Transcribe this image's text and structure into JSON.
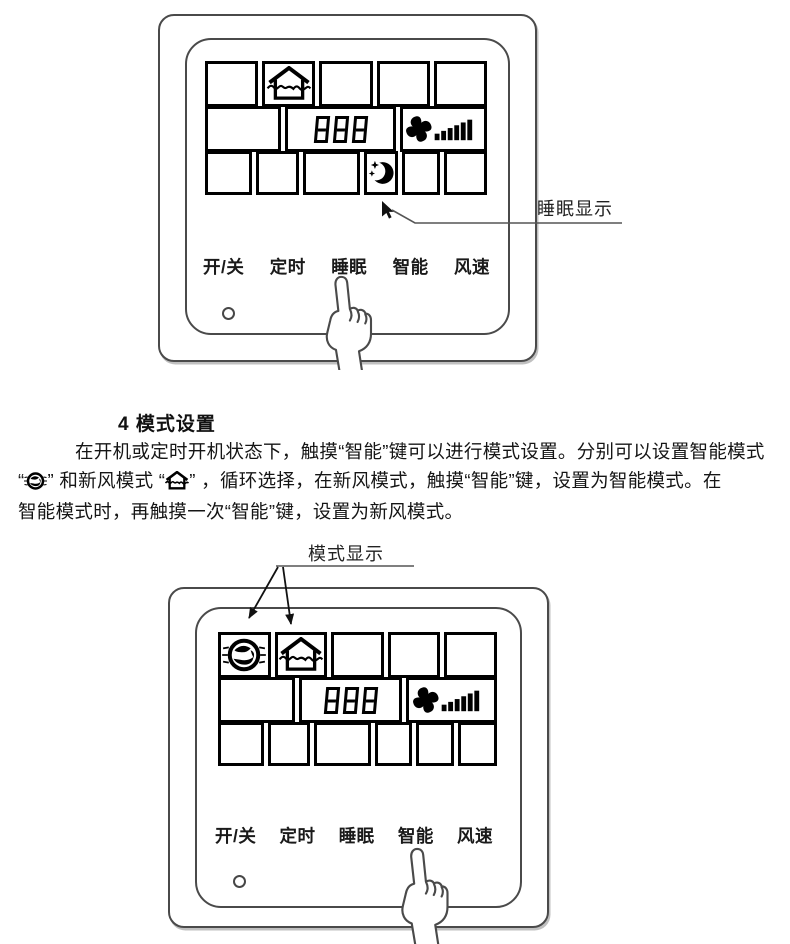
{
  "colors": {
    "ink": "#111111",
    "panel_outline": "#4a4a4a",
    "lcd_line": "#000000",
    "background": "#ffffff"
  },
  "panel_top": {
    "display": {
      "digits": "888",
      "fresh_air_icon": "house-airflow-icon",
      "fan_speed_icon": "fan-speed-bars-icon",
      "sleep_icon": "moon-stars-icon"
    },
    "annotation": "睡眠显示",
    "buttons": [
      "开/关",
      "定时",
      "睡眠",
      "智能",
      "风速"
    ],
    "touched_button": "睡眠"
  },
  "instructions": {
    "heading": "4 模式设置",
    "line1": "在开机或定时开机状态下，触摸“智能”键可以进行模式设置。分别可以设置智能模式",
    "line2_open_quote": "“",
    "line2_mid": "” 和新风模式 “",
    "line2_rest": "” ，循环选择，在新风模式，触摸“智能”键，设置为智能模式。在",
    "line3": "智能模式时，再触摸一次“智能”键，设置为新风模式。",
    "smart_mode_icon": "smart-mode-icon",
    "fresh_air_icon": "house-airflow-icon"
  },
  "panel_bottom": {
    "annotation": "模式显示",
    "display": {
      "digits": "888",
      "smart_icon": "smart-mode-icon",
      "fresh_air_icon": "house-airflow-icon",
      "fan_speed_icon": "fan-speed-bars-icon"
    },
    "buttons": [
      "开/关",
      "定时",
      "睡眠",
      "智能",
      "风速"
    ],
    "touched_button": "智能"
  }
}
